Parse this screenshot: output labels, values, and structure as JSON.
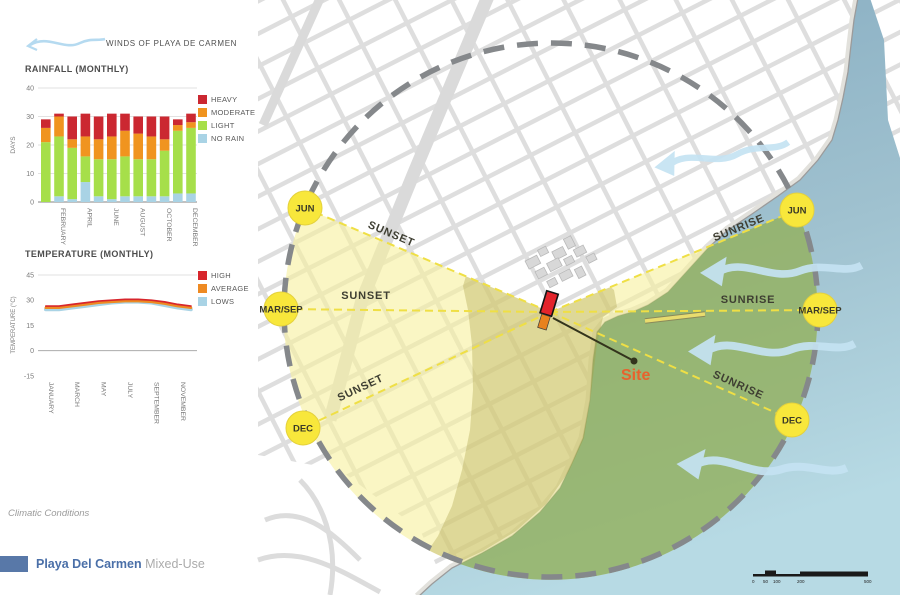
{
  "wind_legend": {
    "label": "WINDS OF PLAYA DE CARMEN"
  },
  "footer": {
    "caption": "Climatic Conditions",
    "project_title": "Playa Del Carmen",
    "project_subtitle": "Mixed-Use"
  },
  "map": {
    "sun_markers": {
      "left": [
        "JUN",
        "MAR/SEP",
        "DEC"
      ],
      "right": [
        "JUN",
        "MAR/SEP",
        "DEC"
      ]
    },
    "sunset_label": "SUNSET",
    "sunrise_label": "SUNRISE",
    "site_label": "Site",
    "scale_labels": [
      "0",
      "50",
      "100",
      "200",
      "500"
    ],
    "colors": {
      "sun_path_yellow": "#F8E73B",
      "sunset_zone": "#F6F09C",
      "sunrise_zone_over_sea": "#91B171",
      "sea": "#85ABC0",
      "wind_arrow": "#C5E3F3",
      "site_red": "#E3242B",
      "site_orange": "#E8821E"
    }
  },
  "chart_data": [
    {
      "type": "bar",
      "stacked": true,
      "title": "RAINFALL (MONTHLY)",
      "ylabel": "DAYS",
      "ylim": [
        0,
        40
      ],
      "yticks": [
        0,
        10,
        20,
        30,
        40
      ],
      "categories": [
        "JANUARY",
        "FEBRUARY",
        "MARCH",
        "APRIL",
        "MAY",
        "JUNE",
        "JULY",
        "AUGUST",
        "SEPTEMBER",
        "OCTOBER",
        "NOVEMBER",
        "DECEMBER"
      ],
      "xtick_shown_start_index": 1,
      "xtick_shown_every": 2,
      "series": [
        {
          "name": "NO RAIN",
          "color": "#A9D3E5",
          "values": [
            0,
            2,
            1,
            7,
            2,
            1,
            2,
            2,
            2,
            2,
            3,
            3
          ]
        },
        {
          "name": "LIGHT",
          "color": "#A6DF4A",
          "values": [
            21,
            21,
            18,
            9,
            13,
            14,
            14,
            13,
            13,
            16,
            22,
            23
          ]
        },
        {
          "name": "MODERATE",
          "color": "#F0941F",
          "values": [
            5,
            7,
            3,
            7,
            7,
            8,
            9,
            9,
            8,
            4,
            2,
            2
          ]
        },
        {
          "name": "HEAVY",
          "color": "#CB2831",
          "values": [
            3,
            1,
            8,
            8,
            8,
            8,
            6,
            6,
            7,
            8,
            2,
            3
          ]
        }
      ]
    },
    {
      "type": "line",
      "title": "TEMPERATURE (MONTHLY)",
      "ylabel": "TEMPERATURE (°C)",
      "ylim": [
        -15,
        45
      ],
      "yticks": [
        45,
        30,
        15,
        0,
        -15
      ],
      "categories": [
        "JANUARY",
        "FEBRUARY",
        "MARCH",
        "APRIL",
        "MAY",
        "JUNE",
        "JULY",
        "AUGUST",
        "SEPTEMBER",
        "OCTOBER",
        "NOVEMBER",
        "DECEMBER"
      ],
      "xtick_shown_start_index": 0,
      "xtick_shown_every": 2,
      "series": [
        {
          "name": "HIGH",
          "color": "#D7262C",
          "values": [
            26.5,
            26.5,
            27.5,
            28.5,
            29.5,
            30,
            30.5,
            30.5,
            30,
            29,
            27.5,
            26.5
          ]
        },
        {
          "name": "AVERAGE",
          "color": "#EE8A22",
          "values": [
            25.5,
            25.5,
            26.5,
            27.5,
            28.5,
            29,
            29.5,
            29.5,
            29,
            28,
            26.5,
            25.5
          ]
        },
        {
          "name": "LOWS",
          "color": "#A9D3E5",
          "values": [
            24.5,
            24.5,
            25.5,
            26.5,
            27.5,
            28.5,
            29,
            29,
            28.5,
            27,
            25.5,
            24.5
          ]
        }
      ]
    }
  ]
}
